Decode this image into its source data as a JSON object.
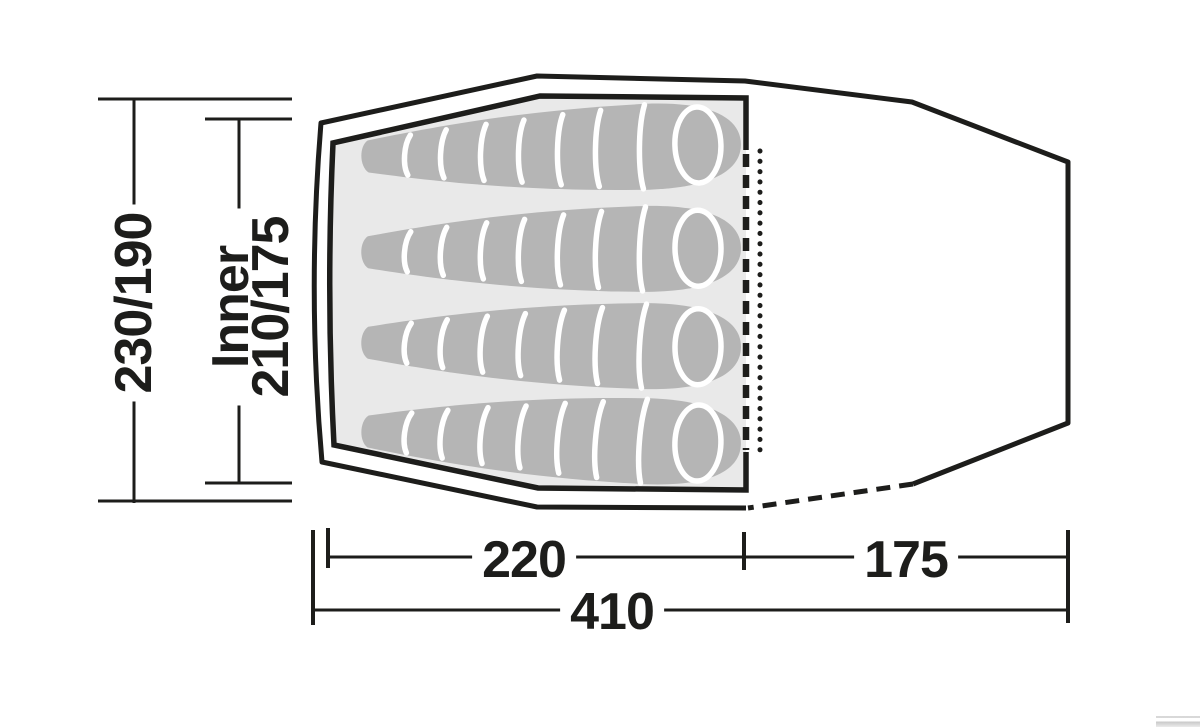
{
  "diagram": {
    "type": "tent-floor-plan-top-view",
    "dimensions": {
      "outer_width": "230/190",
      "inner_label": "Inner",
      "inner_width": "210/175",
      "inner_length": "220",
      "vestibule_length": "175",
      "total_length": "410"
    },
    "sleeping_bags_count": "4",
    "colors": {
      "line": "#1d1d1b",
      "floor": "#e9e9e9",
      "bag": "#b5b5b5",
      "separator": "#ffffff",
      "background": "#ffffff"
    }
  }
}
